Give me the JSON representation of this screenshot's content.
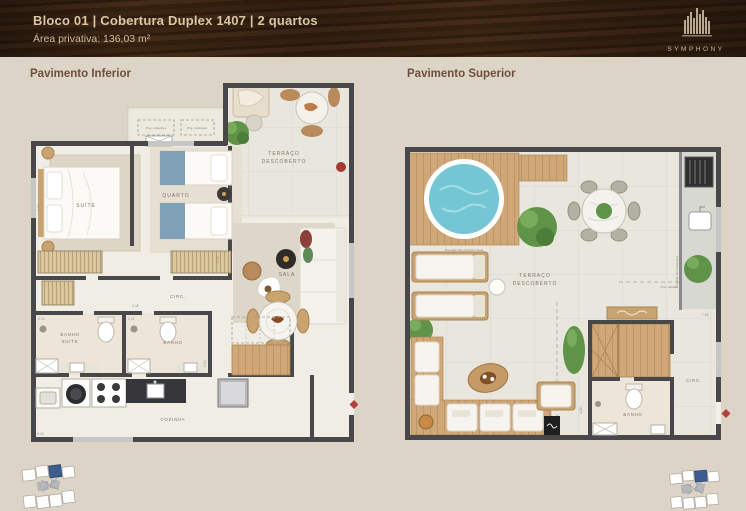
{
  "header": {
    "title": "Bloco 01 | Cobertura Duplex 1407 | 2 quartos",
    "subtitle": "Área privativa: 136,03 m²",
    "brand": "SYMPHONY"
  },
  "colors": {
    "page_bg": "#dcd4c7",
    "header_bg": "#33200f",
    "header_text": "#d9c6a3",
    "accent_red": "#b5413a",
    "pool_water": "#74c6d4",
    "wood": "#c9a473",
    "wall": "#48484a",
    "keyplan_highlight_blue": "#3d5c8f"
  },
  "plans": {
    "inferior": {
      "label": "Pavimento Inferior",
      "rooms": {
        "suite": "SUÍTE",
        "quarto": "QUARTO",
        "sala": "SALA",
        "circ": "CIRC.",
        "banho_suite_l1": "BANHO",
        "banho_suite_l2": "SUÍTE",
        "banho": "BANHO",
        "cozinha": "COZINHA",
        "terraco_l1": "TERRAÇO",
        "terraco_l2": "DESCOBERTO"
      },
      "annotations": {
        "proj_a": "Proj. cobertura",
        "proj_b": "Proj. cobertura"
      },
      "dims": {
        "a": "2.63",
        "b": "2.59",
        "c": "2.49",
        "d": "2.22",
        "e": "2.21",
        "f": "5.44",
        "g": "1.50",
        "h": "3.35"
      }
    },
    "superior": {
      "label": "Pavimento Superior",
      "rooms": {
        "terraco_l1": "TERRAÇO",
        "terraco_l2": "DESCOBERTO",
        "circ": "CIRC.",
        "banho": "BANHO"
      },
      "annotations": {
        "deck_note": "Previsão hid. piscina e deck",
        "grill_note": "Previsão churrasqueira",
        "roof_note": "Proj. telhado"
      },
      "dims": {
        "a": "7.85",
        "b": "4.55"
      }
    }
  }
}
